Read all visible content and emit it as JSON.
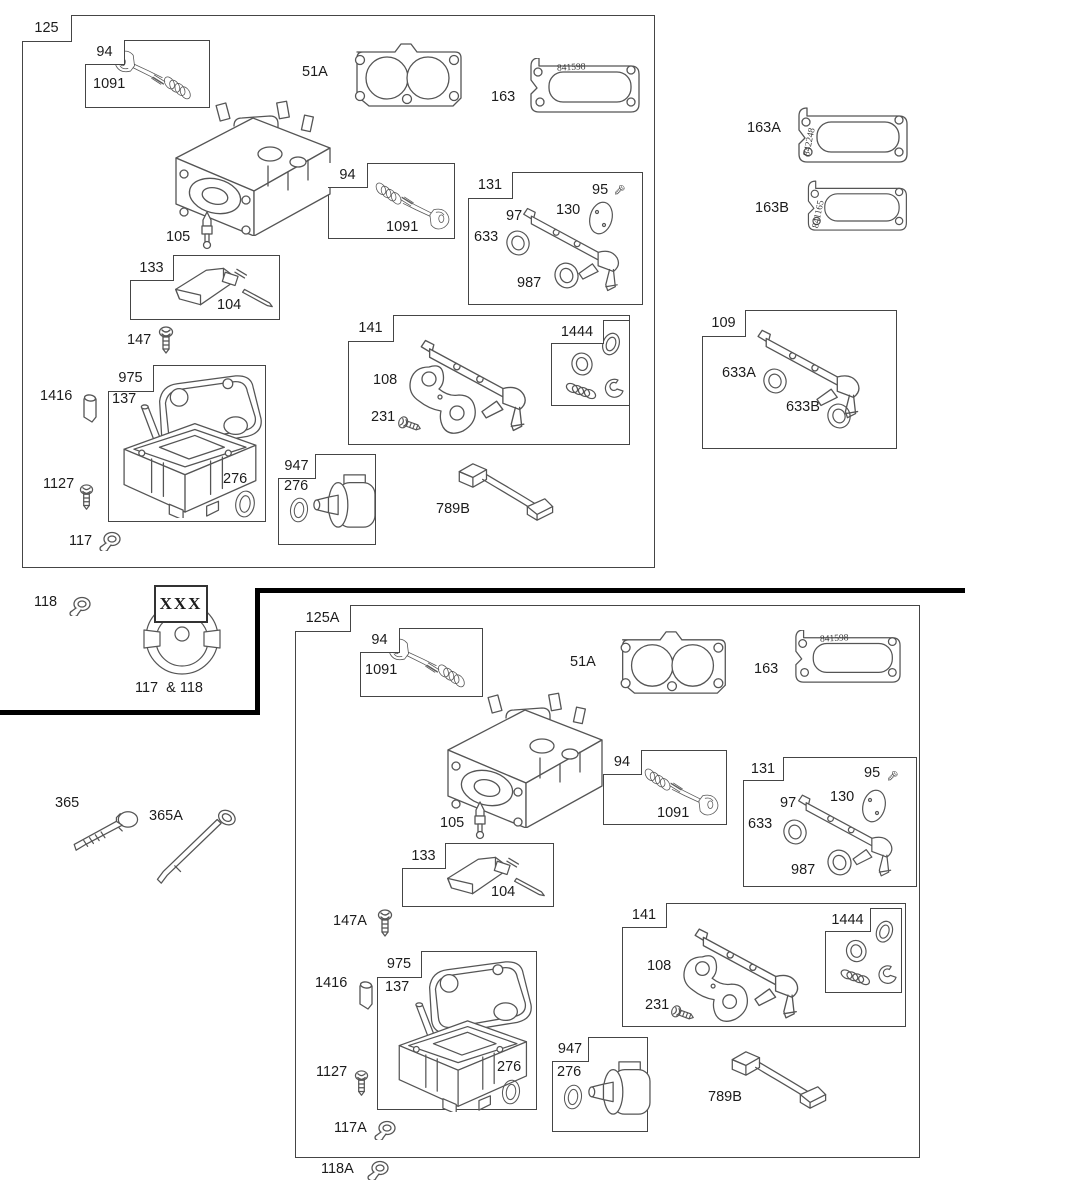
{
  "callouts": {
    "n51A": "51A",
    "n94": "94",
    "n95": "95",
    "n97": "97",
    "n104": "104",
    "n105": "105",
    "n108": "108",
    "n109": "109",
    "n117": "117",
    "n117A": "117A",
    "n118": "118",
    "n118A": "118A",
    "n125": "125",
    "n125A": "125A",
    "n130": "130",
    "n131": "131",
    "n133": "133",
    "n137": "137",
    "n141": "141",
    "n147": "147",
    "n147A": "147A",
    "n163": "163",
    "n163A": "163A",
    "n163B": "163B",
    "n231": "231",
    "n276": "276",
    "n365": "365",
    "n365A": "365A",
    "n633": "633",
    "n633A": "633A",
    "n633B": "633B",
    "n789B": "789B",
    "n947": "947",
    "n975": "975",
    "n987": "987",
    "n1091": "1091",
    "n1127": "1127",
    "n1416": "1416",
    "n1444": "1444"
  },
  "stamps": {
    "g841598": "841598",
    "g842248": "842248",
    "g841165": "841165"
  },
  "legend": {
    "xxx": "XXX",
    "combo": "117  & 118"
  }
}
